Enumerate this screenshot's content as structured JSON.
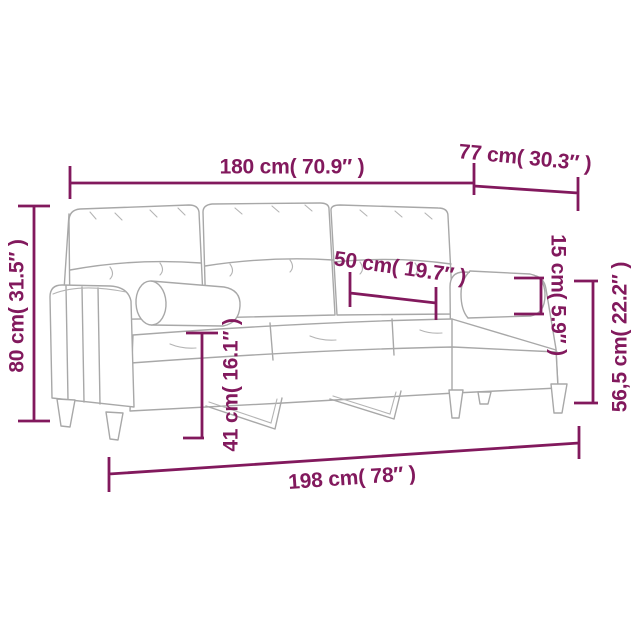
{
  "diagram": {
    "kind": "sofa-dimension-diagram",
    "colors": {
      "background": "#ffffff",
      "dimension_accent": "#82195d",
      "sketch_line": "#a8a8a8"
    },
    "dimensions": [
      {
        "id": "overall-width",
        "label": "180 cm( 70.9″ )",
        "cm": "180",
        "inches": "70.9"
      },
      {
        "id": "overall-depth",
        "label": "77 cm( 30.3″ )",
        "cm": "77",
        "inches": "30.3"
      },
      {
        "id": "overall-height",
        "label": "80 cm( 31.5″ )",
        "cm": "80",
        "inches": "31.5"
      },
      {
        "id": "seat-cushion-width",
        "label": "50 cm( 19.7″ )",
        "cm": "50",
        "inches": "19.7"
      },
      {
        "id": "bolster-diameter",
        "label": "15 cm( 5.9″ )",
        "cm": "15",
        "inches": "5.9"
      },
      {
        "id": "arm-height",
        "label": "56,5 cm( 22.2″ )",
        "cm": "56,5",
        "inches": "22.2"
      },
      {
        "id": "seat-height",
        "label": "41 cm( 16.1″ )",
        "cm": "41",
        "inches": "16.1"
      },
      {
        "id": "overall-length",
        "label": "198 cm( 78″ )",
        "cm": "198",
        "inches": "78"
      }
    ]
  }
}
